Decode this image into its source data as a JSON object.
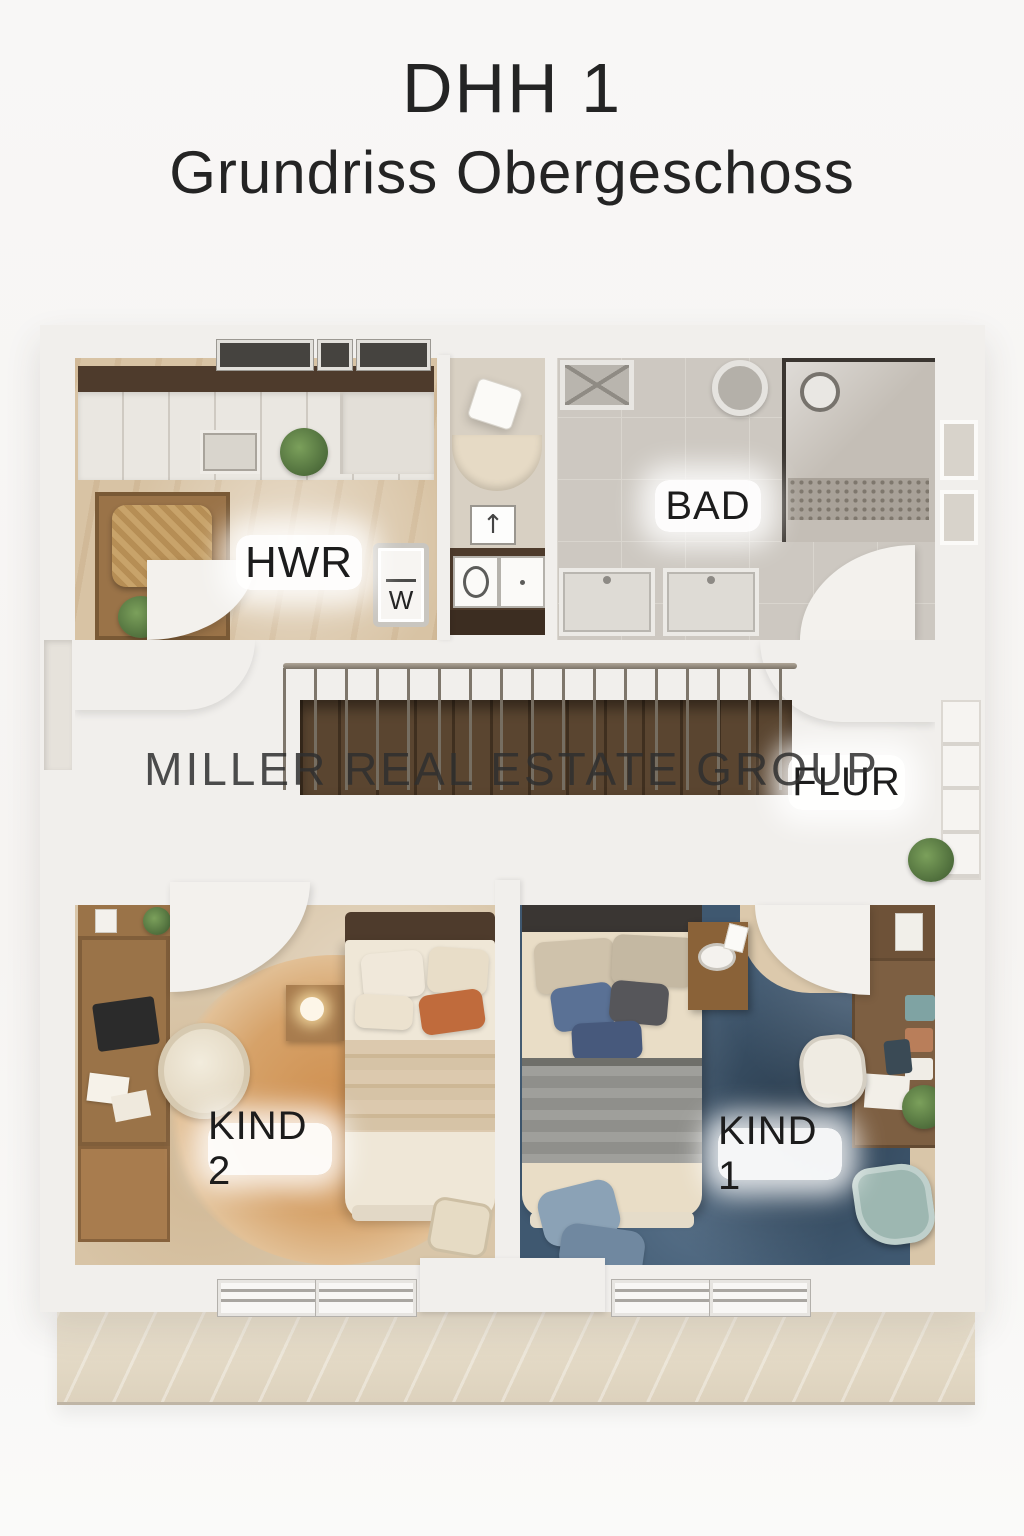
{
  "title": {
    "line1": "DHH 1",
    "line2": "Grundriss Obergeschoss"
  },
  "watermark": "MILLER REAL ESTATE GROUP",
  "rooms": {
    "hwr": {
      "label": "HWR"
    },
    "bad": {
      "label": "BAD"
    },
    "flur": {
      "label": "FLUR"
    },
    "kind2": {
      "label": "KIND 2"
    },
    "kind1": {
      "label": "KIND 1"
    }
  },
  "appliances": {
    "washer_label": "W"
  },
  "icons": {
    "arrow_up": "↑"
  },
  "colors": {
    "title": "#242424",
    "watermark": "#2f2f2f",
    "label_text": "#1c1c1c",
    "wall": "#f1efec",
    "floor_hwr": "#d8c3a4",
    "floor_niche": "#d8d0c3",
    "floor_bad": "#cdc8c1",
    "floor_flur": "#e9dfca",
    "floor_kind2": "#d9c6a9",
    "carpet_blue": "#3f5870",
    "rug_orange": "#d39a5f",
    "stair_wood": "#4a3a29",
    "wood_dark": "#4e3b2c",
    "wood_mid": "#9a7348",
    "wood_light": "#a87c4e",
    "accent_orange": "#c06b3c",
    "teal_chair": "#9db7b1"
  }
}
